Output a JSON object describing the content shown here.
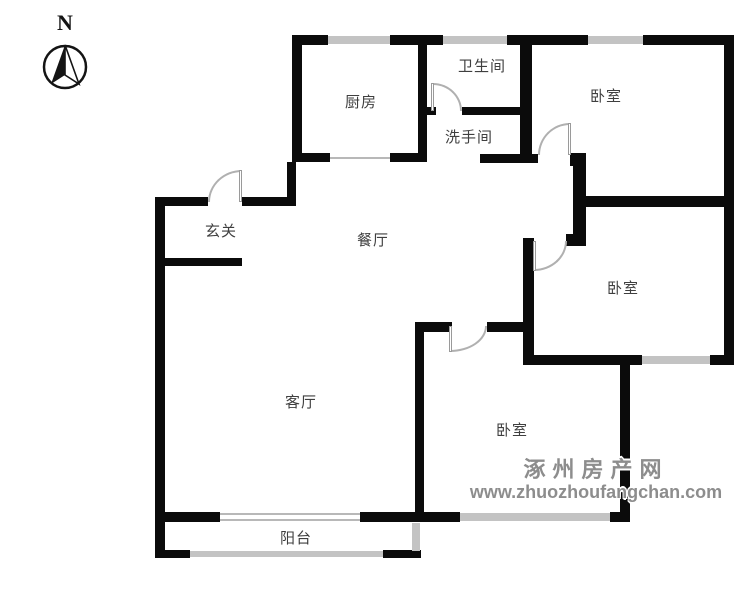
{
  "compass": {
    "north_label": "N"
  },
  "rooms": {
    "kitchen": "厨房",
    "bathroom": "卫生间",
    "washroom": "洗手间",
    "bedroom_top": "卧室",
    "bedroom_middle": "卧室",
    "bedroom_bottom": "卧室",
    "entrance": "玄关",
    "dining": "餐厅",
    "living": "客厅",
    "balcony": "阳台"
  },
  "watermark": {
    "site_name": "涿州房产网",
    "site_url": "www.zhuozhoufangchan.com"
  },
  "colors": {
    "wall": "#0b0b0b",
    "window": "#c3c3c3",
    "door_arc": "#b0b0b0",
    "label_text": "#3f3f3f",
    "watermark_text": "#8d8d8d"
  }
}
